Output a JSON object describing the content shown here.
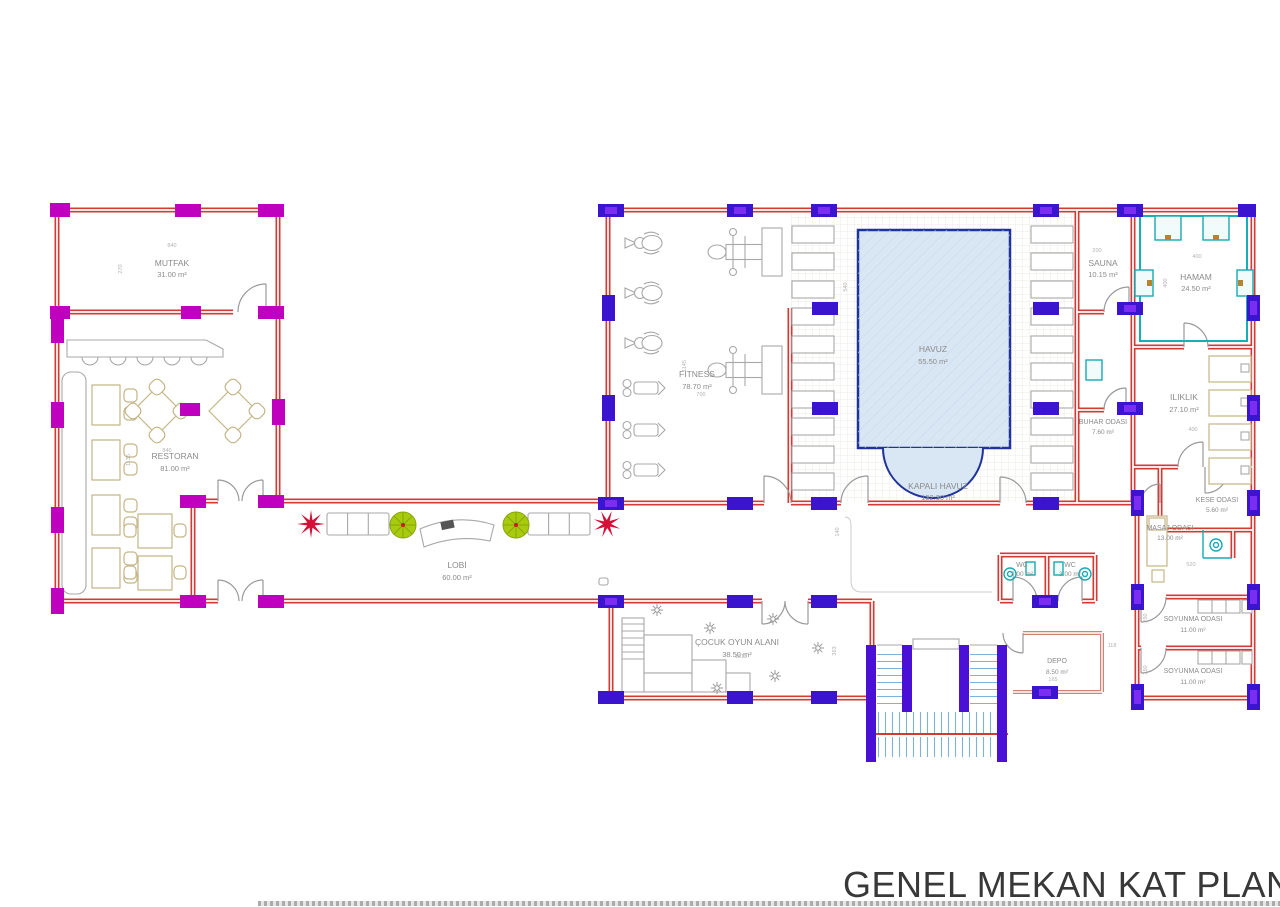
{
  "title": "GENEL MEKAN KAT PLANI",
  "rooms": {
    "mutfak": {
      "name": "MUTFAK",
      "area": "31.00 m²"
    },
    "restoran": {
      "name": "RESTORAN",
      "area": "81.00 m²"
    },
    "lobi": {
      "name": "LOBİ",
      "area": "60.00 m²"
    },
    "fitness": {
      "name": "FITNESS",
      "area": "78.70 m²"
    },
    "havuz": {
      "name": "HAVUZ",
      "area": "55.50 m²"
    },
    "kapali": {
      "name": "KAPALI HAVUZ",
      "area": "132.30 m²"
    },
    "sauna": {
      "name": "SAUNA",
      "area": "10.15 m²"
    },
    "hamam": {
      "name": "HAMAM",
      "area": "24.50 m²"
    },
    "iliklik": {
      "name": "ILIKLIK",
      "area": "27.10 m²"
    },
    "buhar": {
      "name": "BUHAR ODASI",
      "area": "7.60 m²"
    },
    "kese": {
      "name": "KESE ODASI",
      "area": "5.60 m²"
    },
    "masaj": {
      "name": "MASAJ ODASI",
      "area": "13.00 m²"
    },
    "soyunma1": {
      "name": "SOYUNMA ODASI",
      "area": "11.00 m²"
    },
    "soyunma2": {
      "name": "SOYUNMA ODASI",
      "area": "11.00 m²"
    },
    "wc1": {
      "name": "WC",
      "area": "3.00 m²"
    },
    "wc2": {
      "name": "WC",
      "area": "3.00 m²"
    },
    "depo": {
      "name": "DEPO",
      "area": "8.50 m²"
    },
    "cocuk": {
      "name": "ÇOCUK OYUN ALANI",
      "area": "38.50 m²"
    }
  },
  "dims": {
    "mutfak_w": "840",
    "mutfak_d": "270",
    "restoran_w": "840",
    "restoran_d": "1135",
    "fitness_d": "1145",
    "fitness_w": "700",
    "pool_d": "540",
    "sauna_w": "200",
    "hamam_w": "400",
    "hamam_d": "400",
    "iliklik_w": "400",
    "play_w": "1613",
    "play_d": "363",
    "circ_d": "140",
    "depo_w": "165",
    "depo_s": "118",
    "masaj_w": "520",
    "soy1_d": "250",
    "soy2_d": "250"
  },
  "colors": {
    "wall_red": "#d43a35",
    "column_magenta": "#bf00bf",
    "column_indigo": "#3a14cf",
    "pool_fill": "#d9e6f4",
    "pool_border": "#20339b",
    "hamam_teal": "#16aab4",
    "plant_green": "#a8cc0d",
    "accent_red": "#d51038",
    "stair_cyan": "#7fb2d6"
  }
}
